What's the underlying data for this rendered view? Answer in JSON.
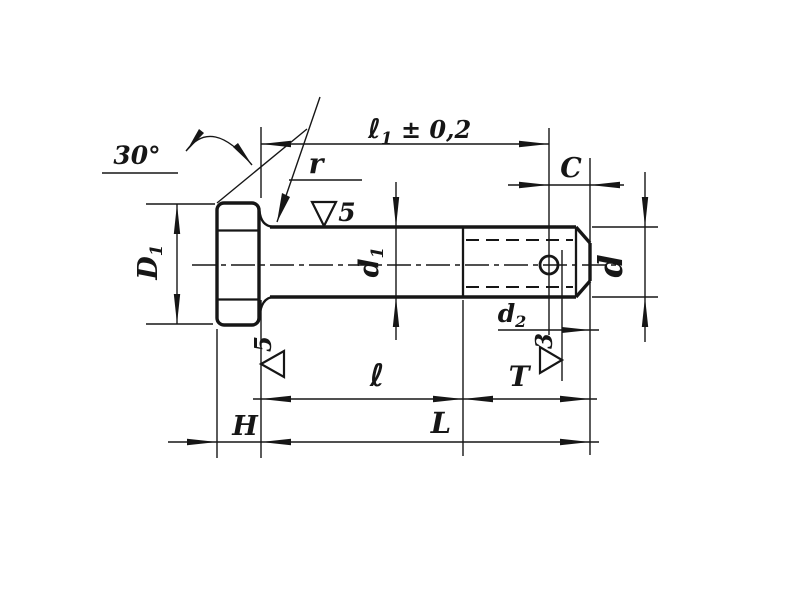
{
  "drawing": {
    "kind": "technical-drawing",
    "colors": {
      "ink": "#161616",
      "paper": "#ffffff"
    },
    "labels": {
      "angle_30": "30°",
      "fillet_r": "r",
      "dim_l1": {
        "main": "ℓ",
        "sub": "1",
        "tol": " ± 0,2"
      },
      "dim_C": "C",
      "dim_D1": {
        "main": "D",
        "sub": "1"
      },
      "dim_d1": {
        "main": "d",
        "sub": "1"
      },
      "dim_d": "d",
      "dim_d2": {
        "main": "d",
        "sub": "2"
      },
      "dim_l": "ℓ",
      "dim_T": "T",
      "dim_L": "L",
      "dim_H": "H",
      "finish_shank": "5",
      "finish_bearing": "5",
      "finish_thread": "3"
    }
  }
}
